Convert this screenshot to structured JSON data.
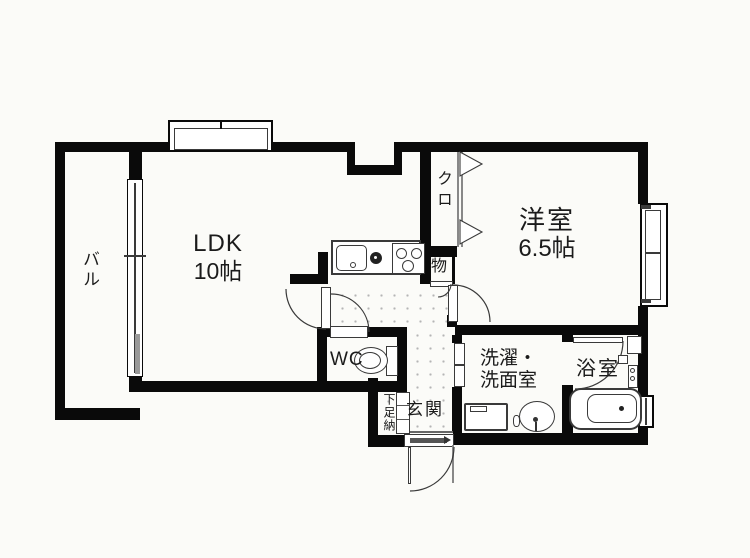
{
  "plan": {
    "title": "1LDK floor plan",
    "rooms": {
      "balcony": "バル",
      "ldk": "LDK",
      "ldk_size": "10帖",
      "closet": "クロ",
      "storage": "物",
      "western_room": "洋室",
      "western_room_size": "6.5帖",
      "wc": "WC",
      "laundry_line1": "洗濯・",
      "laundry_line2": "洗面室",
      "bathroom": "浴室",
      "entrance": "玄関",
      "shoe_cabinet": "下足納"
    },
    "colors": {
      "wall": "#0a0a0a",
      "line": "#3a3a3a",
      "background": "#fbfbf8",
      "dot": "#b5b5b5",
      "sash": "#999999",
      "text": "#1b1b1b"
    }
  }
}
